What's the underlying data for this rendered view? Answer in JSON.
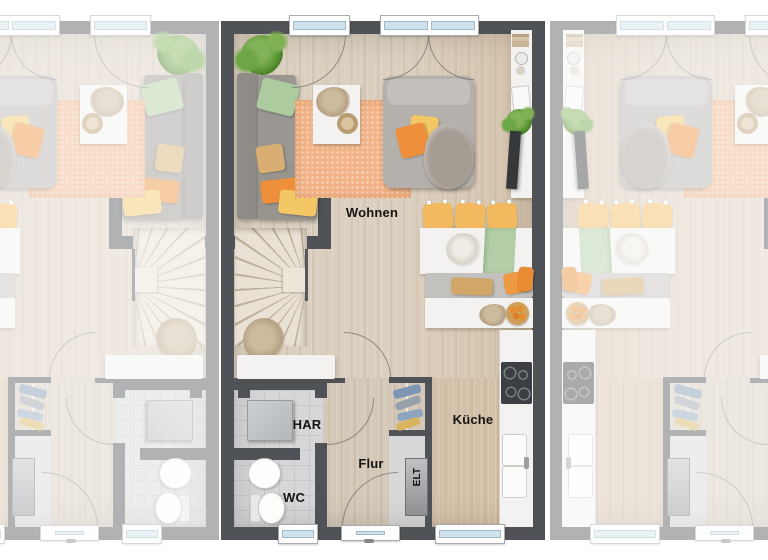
{
  "rooms": {
    "living": "Wohnen",
    "kitchen": "Küche",
    "hallway": "Flur",
    "utility_room": "HAR",
    "wc": "WC",
    "electrical": "ELT"
  },
  "palette": {
    "wall": "#4f5256",
    "wood_floor": "#dbcfbf",
    "kitchen_floor": "#d5c1a9",
    "tile_floor": "#d6d7d9",
    "rug": "#f1b387",
    "sofa": "#9a9793",
    "chair": "#f2b95e",
    "accent_orange": "#ee8f3b",
    "accent_yellow": "#f2c764",
    "accent_green": "#accb9f",
    "runner_green": "#b4cfa7",
    "window_glass": "#cfe3ee",
    "furniture_white": "#f3f2f0",
    "background": "#ffffff"
  },
  "units": {
    "count": 3,
    "highlighted": "middle"
  }
}
